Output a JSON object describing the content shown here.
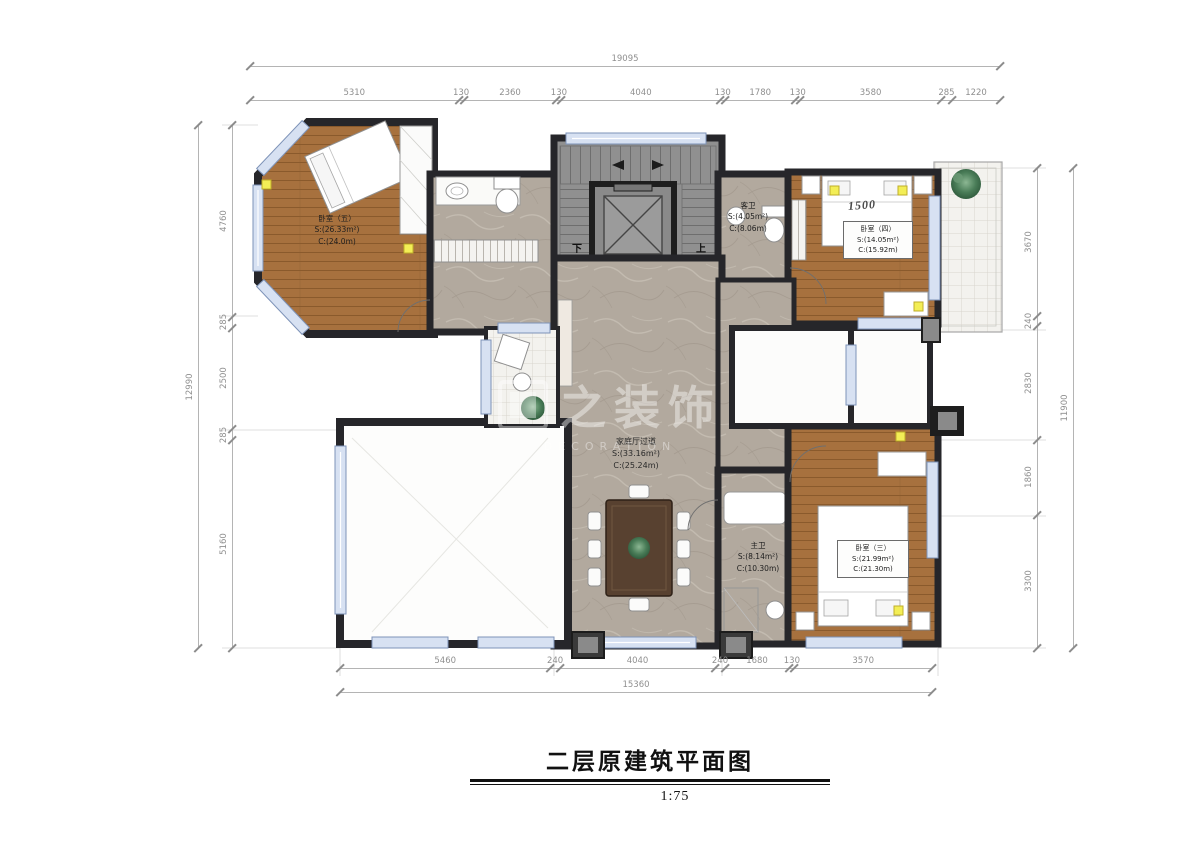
{
  "title": {
    "text": "二层原建筑平面图",
    "scale": "1:75"
  },
  "watermark": {
    "cn": "之装饰",
    "en": "DECORATION"
  },
  "plan": {
    "stair_down": "下",
    "stair_up": "上",
    "bed_width_label": "1500",
    "rooms": [
      {
        "name": "卧室（五）",
        "area": "S:(26.33m²)",
        "girth": "C:(24.0m)"
      },
      {
        "name": "客卫",
        "area": "S:(4.05m²)",
        "girth": "C:(8.06m)"
      },
      {
        "name": "卧室（四）",
        "area": "S:(14.05m²)",
        "girth": "C:(15.92m)"
      },
      {
        "name": "家庭厅过道",
        "area": "S:(33.16m²)",
        "girth": "C:(25.24m)"
      },
      {
        "name": "主卫",
        "area": "S:(8.14m²)",
        "girth": "C:(10.30m)"
      },
      {
        "name": "卧室（三）",
        "area": "S:(21.99m²)",
        "girth": "C:(21.30m)"
      }
    ]
  },
  "dimensions": {
    "top": {
      "total": "19095",
      "segments": [
        5310,
        130,
        2360,
        130,
        4040,
        130,
        1780,
        130,
        3580,
        285,
        1220
      ]
    },
    "bottom": {
      "total": "15360",
      "segments": [
        5460,
        240,
        4040,
        240,
        1680,
        130,
        3570
      ]
    },
    "left": {
      "total": "12990",
      "segments": [
        4760,
        285,
        2500,
        285,
        5160
      ]
    },
    "right": {
      "total": "11900",
      "segments": [
        3670,
        240,
        2830,
        1860,
        3300
      ]
    }
  },
  "colors": {
    "wall": "#26262a",
    "wood": "#a7713e",
    "marble": "#b2a99e",
    "window": "#d7e1f2",
    "dim_text": "#8f8f8f",
    "marker_yellow": "#f3ee56"
  }
}
